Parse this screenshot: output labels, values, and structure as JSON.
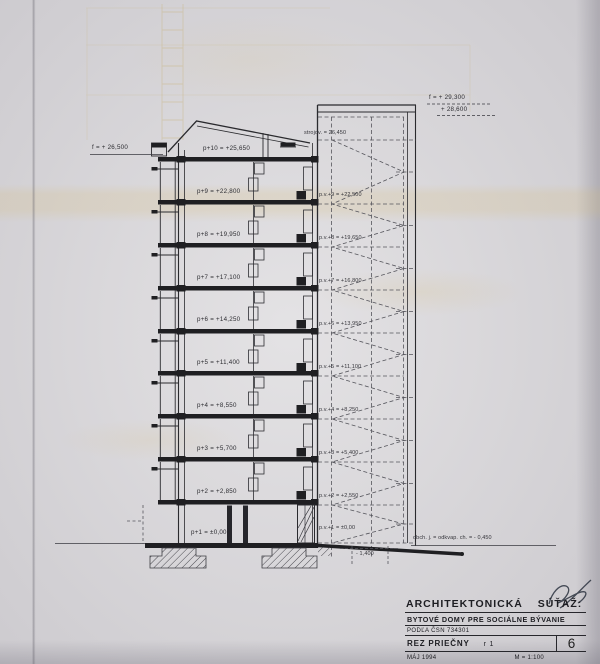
{
  "sheet": {
    "elevation_marks": {
      "roof_left": "f = + 26,500",
      "tower_top_upper": "f = + 29,300",
      "tower_top_lower": "+ 28,600",
      "machine_room": "strojov. = 26,450",
      "entry_level": "obch. j. = odkvap. ch. = - 0,450",
      "pit_depth": "- 1,400"
    },
    "floors": [
      "p+10 = +25,650",
      "p+9 = +22,800",
      "p+8 = +19,950",
      "p+7 = +17,100",
      "p+6 = +14,250",
      "p+5 = +11,400",
      "p+4 = +8,550",
      "p+3 = +5,700",
      "p+2 = +2,850",
      "p+1 = ±0,00"
    ],
    "gallery_levels": [
      "p.v.+9 = +22,500",
      "p.v.+8 = +19,650",
      "p.v.+7 = +16,800",
      "p.v.+6 = +13,950",
      "p.v.+5 = +11,100",
      "p.v.+4 = +8,250",
      "p.v.+3 = +5,400",
      "p.v.+2 = +2,550",
      "p.v.+1 = ±0,00"
    ],
    "title_block": {
      "heading": "ARCHITEKTONICKÁ SÚŤAŽ:",
      "project": "BYTOVÉ DOMY PRE SOCIÁLNE BÝVANIE",
      "standard": "PODĽA ČSN 734301",
      "drawing_name": "REZ PRIEČNY",
      "drawing_code": "r 1",
      "sheet_number": "6",
      "date": "MÁJ 1994",
      "scale": "M = 1:100"
    }
  }
}
